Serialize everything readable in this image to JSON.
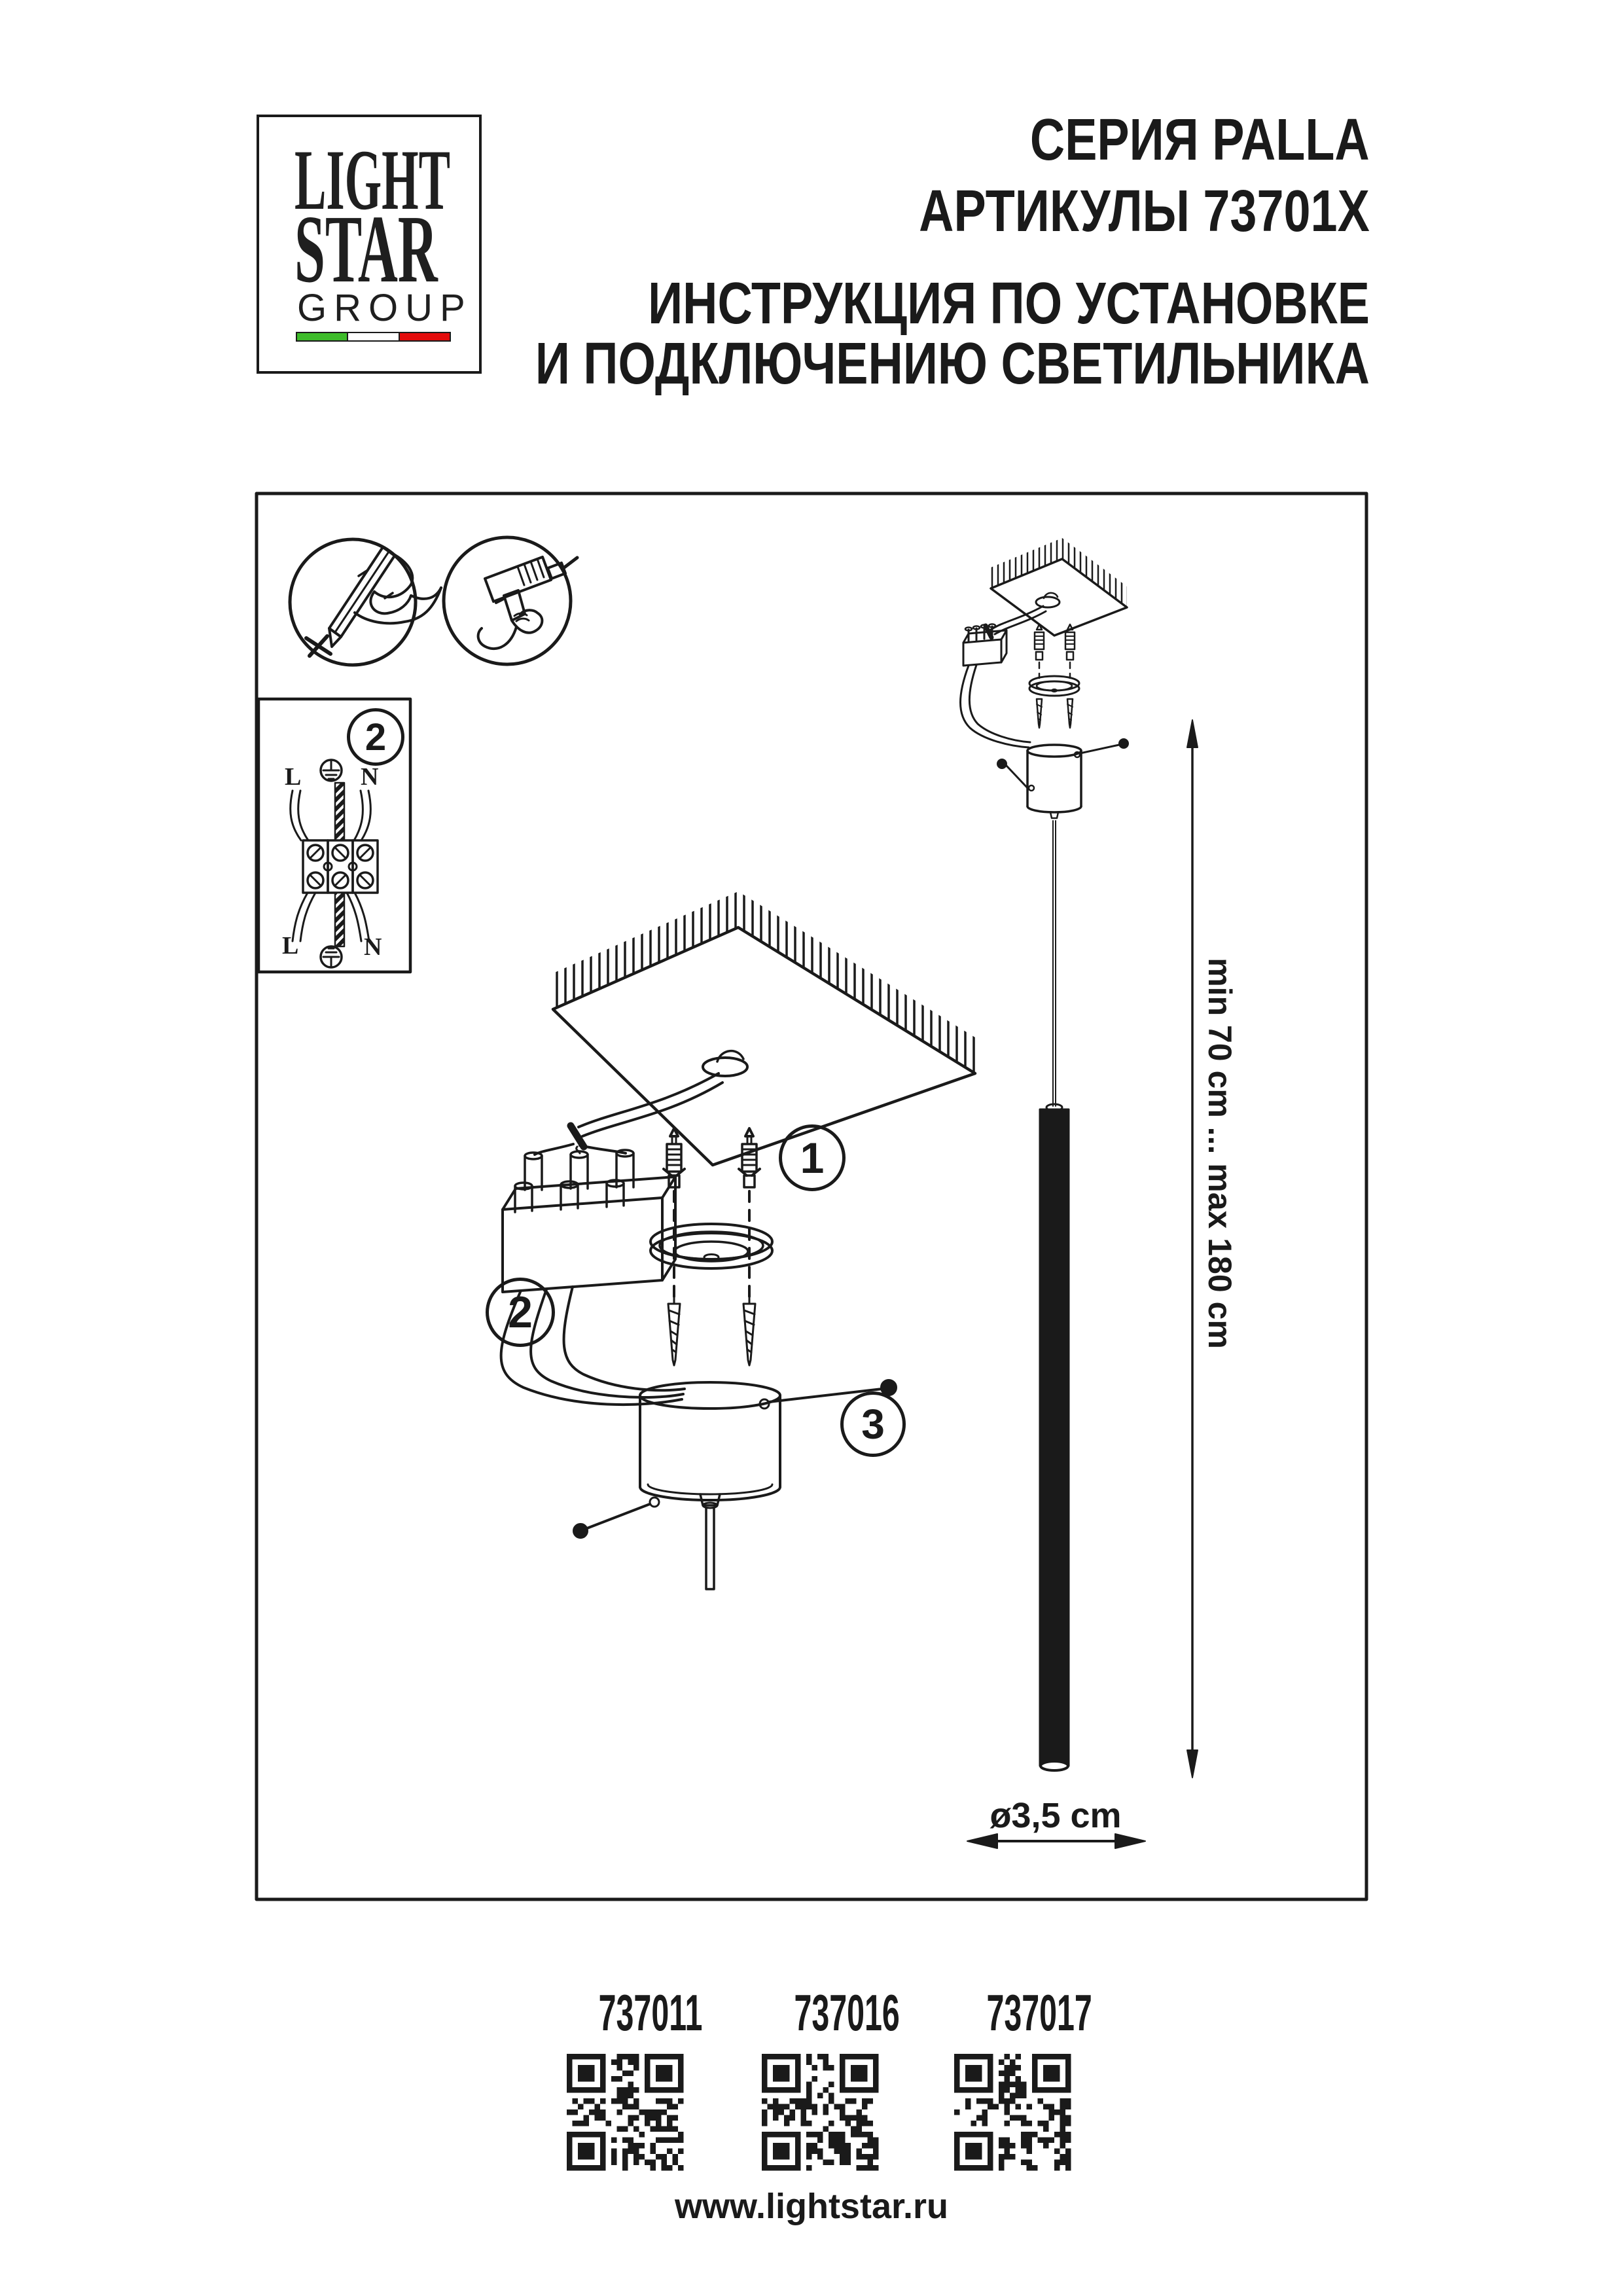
{
  "logo": {
    "light": "LIGHT",
    "star": "STAR",
    "group": "GROUP"
  },
  "header": {
    "series": "СЕРИЯ PALLA",
    "articles": "АРТИКУЛЫ 73701X",
    "instruction1": "ИНСТРУКЦИЯ ПО УСТАНОВКЕ",
    "instruction2": "И ПОДКЛЮЧЕНИЮ СВЕТИЛЬНИКА"
  },
  "wiring": {
    "step": "2",
    "l_top": "L",
    "n_top": "N",
    "l_bottom": "L",
    "n_bottom": "N"
  },
  "steps": {
    "one": "1",
    "two": "2",
    "three": "3"
  },
  "dimensions": {
    "suspension_range": "min 70 cm ... max 180 cm",
    "diameter": "ø3,5 cm"
  },
  "products": [
    {
      "code": "737011"
    },
    {
      "code": "737016"
    },
    {
      "code": "737017"
    }
  ],
  "footer": {
    "website": "www.lightstar.ru"
  },
  "icons": [
    "pencil-marking-icon",
    "drill-icon",
    "earth-ground-icon",
    "qr-code"
  ],
  "colors": {
    "ink": "#1a1a1a",
    "flag_green": "#3dbb2a",
    "flag_white": "#ffffff",
    "flag_red": "#e30c0c"
  }
}
